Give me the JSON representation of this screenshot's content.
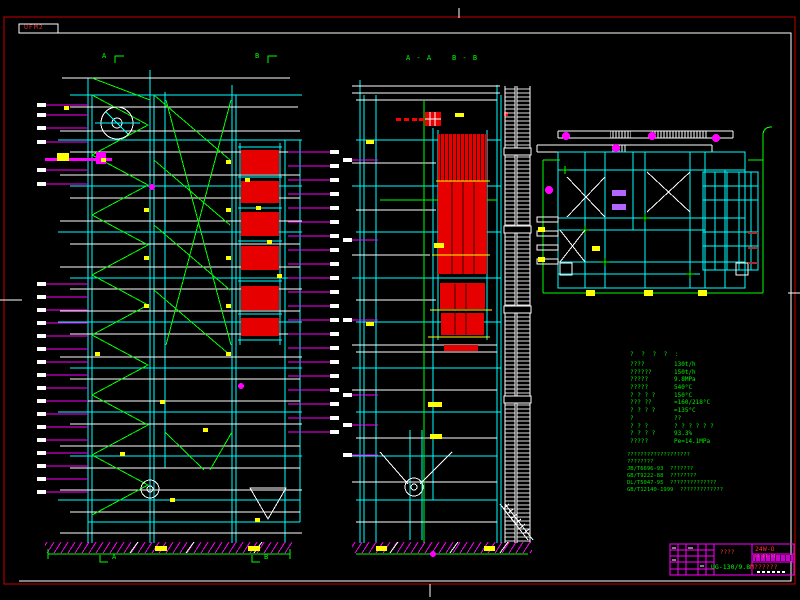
{
  "sheet": {
    "corner_stamp": "UFM2"
  },
  "views": {
    "left": {
      "top_a": "A",
      "top_b": "B",
      "bottom_a": "A",
      "bottom_b": "B"
    },
    "middle": {
      "section_a": "A - A",
      "section_b": "B - B"
    }
  },
  "parameters": {
    "header": "? ? ? ? :",
    "rows": [
      {
        "label": "????",
        "value": "130t/h"
      },
      {
        "label": "??????",
        "value": "150t/h"
      },
      {
        "label": "?????",
        "value": "9.8MPa"
      },
      {
        "label": "?????",
        "value": "540°C"
      },
      {
        "label": "? ? ? ?",
        "value": "150°C"
      },
      {
        "label": "??? ??",
        "value": "≈160/218°C"
      },
      {
        "label": "? ? ? ?",
        "value": "=135°C"
      },
      {
        "label": "?",
        "value": "??"
      },
      {
        "label": "? ? ?",
        "value": "? ? ? ? ? ?"
      },
      {
        "label": "? ? ? ?",
        "value": "93.3%"
      },
      {
        "label": "?????",
        "value": "Pe=14.1MPa"
      }
    ]
  },
  "notes": {
    "lines": [
      "???????????????????",
      "????????",
      "JB/T6696-93  ???????",
      "GB/T9222-88  ????????",
      "DL/T5047-95  ??????????????",
      "GB/T12140-1999  ?????????????"
    ]
  },
  "title_block": {
    "stamp": "????",
    "drawing_no": "24W-O",
    "sheet_info": "?? ?? ??",
    "model": "UG-130/9.8",
    "model_suffix": "M??????"
  },
  "palette": {
    "background": "#000000",
    "border_red": "#c80000",
    "line_cyan": "#00ffff",
    "line_green": "#00ff00",
    "line_white": "#ffffff",
    "line_magenta": "#ff00ff",
    "fill_red": "#e60000",
    "accent_yellow": "#ffff00",
    "violet": "#b266ff"
  }
}
